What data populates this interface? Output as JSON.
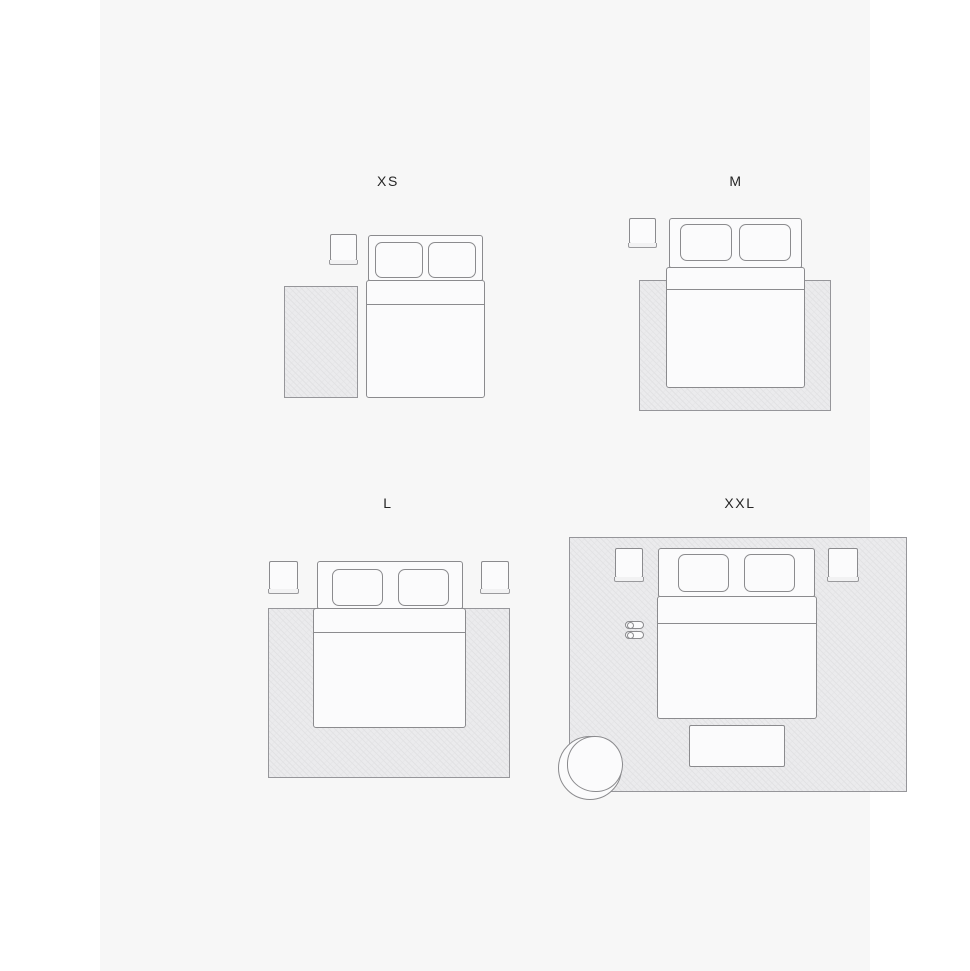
{
  "sections": [
    {
      "id": "xs",
      "label": "XS"
    },
    {
      "id": "m",
      "label": "M"
    },
    {
      "id": "l",
      "label": "L"
    },
    {
      "id": "xxl",
      "label": "XXL"
    }
  ],
  "colors": {
    "page_background": "#ffffff",
    "content_background": "#f7f7f7",
    "furniture_fill": "#fbfbfc",
    "furniture_outline": "#8b8b8e",
    "rug_fill": "#ebebed",
    "rug_hatch": "#e2e2e4",
    "rug_border": "#96969a",
    "label_text": "#262626"
  }
}
